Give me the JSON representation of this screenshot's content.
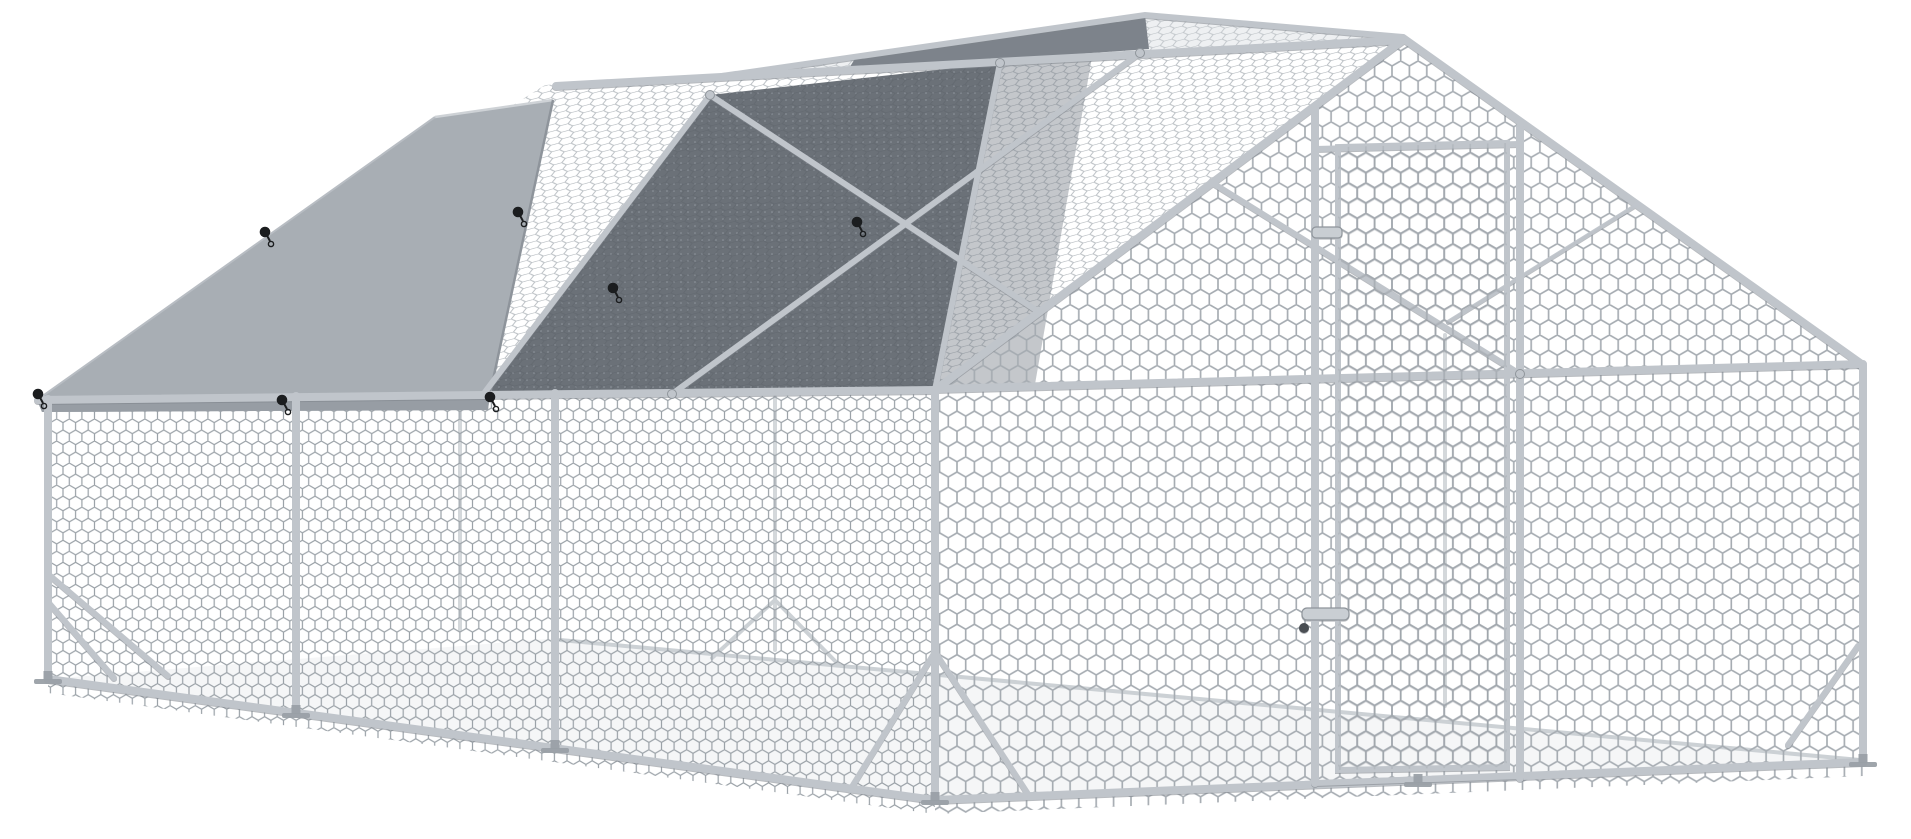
{
  "scene": {
    "subject": "walk-in-metal-chicken-run-cage",
    "parts": {
      "frame": "galvanized-steel-tube-frame",
      "mesh": "hexagonal-chicken-wire-mesh",
      "tarp": "gray-waterproof-roof-cover",
      "shade": "dark-shade-mesh-roof-panel",
      "door": "lockable-mesh-door",
      "latch": "sliding-bolt-latch",
      "toggles": "black-ball-bungee-ties",
      "feet": "post-ground-feet"
    }
  },
  "colors": {
    "bg": "#ffffff",
    "ground": "#f5f6f7",
    "tarp": "#a8aeb4",
    "tarp-edge": "#ced2d6",
    "tarp-skirt": "#979da4",
    "shade": "#6b7178",
    "shade-far": "#7d838b",
    "mesh": "#a6acb2",
    "mesh-left": "#9aa1a7",
    "mesh-roof": "#b0b6bb",
    "frame": "#c0c5cb",
    "frame-far": "#ccd1d5",
    "frame-shadow": "#8f959b",
    "hardware": "#c9ced3",
    "toggle": "#1b1d1f",
    "foot": "#9aa0a7"
  },
  "toggles": [
    {
      "x": 38,
      "y": 394
    },
    {
      "x": 265,
      "y": 232
    },
    {
      "x": 518,
      "y": 212
    },
    {
      "x": 282,
      "y": 400
    },
    {
      "x": 490,
      "y": 397
    },
    {
      "x": 613,
      "y": 288
    },
    {
      "x": 857,
      "y": 222
    }
  ],
  "feet": [
    {
      "x": 48,
      "y": 679
    },
    {
      "x": 296,
      "y": 713
    },
    {
      "x": 555,
      "y": 748
    },
    {
      "x": 935,
      "y": 800
    },
    {
      "x": 1418,
      "y": 782
    },
    {
      "x": 1863,
      "y": 762
    }
  ],
  "clamps": [
    {
      "x": 710,
      "y": 95
    },
    {
      "x": 1000,
      "y": 63
    },
    {
      "x": 1140,
      "y": 53
    },
    {
      "x": 672,
      "y": 394
    },
    {
      "x": 1520,
      "y": 374
    }
  ]
}
